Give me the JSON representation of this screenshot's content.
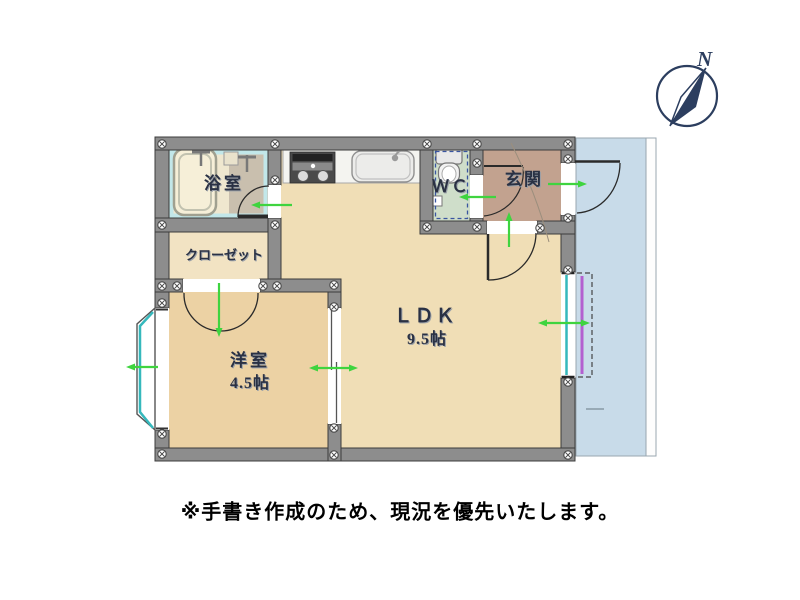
{
  "note": "※手書き作成のため、現況を優先いたします。",
  "compass": {
    "label": "N"
  },
  "rooms": {
    "bathroom": {
      "label": "浴室"
    },
    "wc": {
      "label": "ＷＣ"
    },
    "entrance": {
      "label": "玄関"
    },
    "closet": {
      "label": "クローゼット"
    },
    "western_room": {
      "label": "洋室",
      "size": "4.5帖"
    },
    "ldk": {
      "label": "ＬＤＫ",
      "size": "9.5帖"
    }
  },
  "colors": {
    "ldk_floor": "#f0deb6",
    "western_room_floor": "#ecd2a4",
    "closet_floor": "#f2e3c3",
    "entrance_floor": "#c2a28f",
    "wc_floor": "#cfdeca",
    "bathroom_floor": "#c9bfae",
    "bathroom_lining": "#c2e7e9",
    "balcony": "#c8dbe9",
    "wall": "#8d8d8d",
    "window_glass": "#35b8bc",
    "door_arrow": "#3fd43f",
    "shutter": "#b35fd0",
    "compass": "#2c3e5f"
  }
}
